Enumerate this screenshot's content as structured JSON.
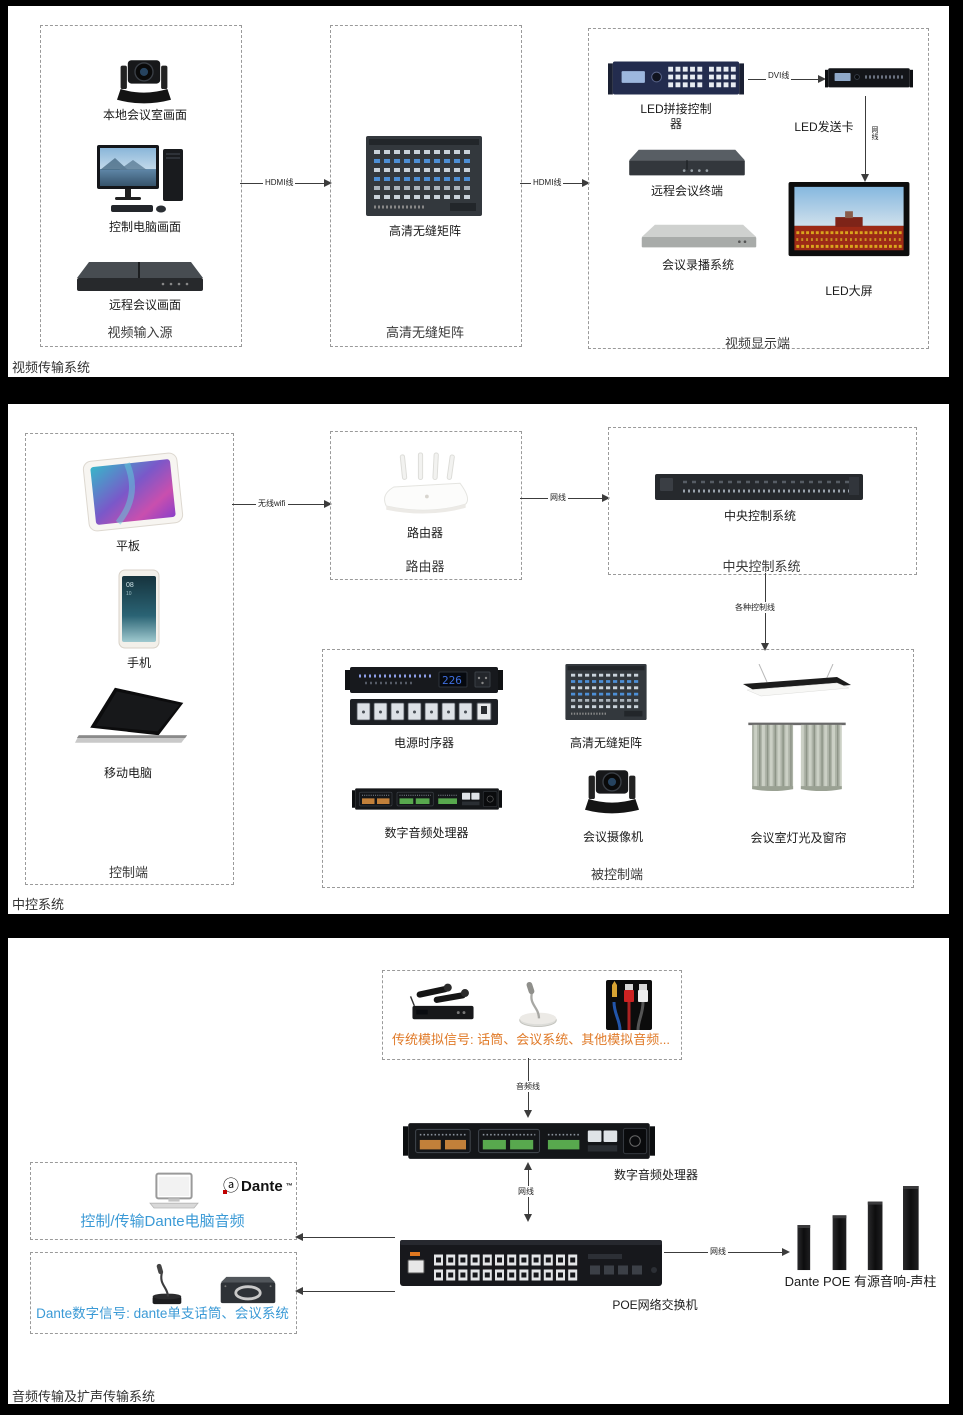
{
  "power_display": "226",
  "phone_screen": {
    "time": "08",
    "date": "10"
  },
  "colors": {
    "analog_label": "#e07a28",
    "dante_label": "#3b9ad6",
    "arrow": "#3c3c3c",
    "dante_logo_red": "#c00000"
  },
  "sections": {
    "video": {
      "label": "视频传输系统",
      "input_box": {
        "label": "视频输入源",
        "camera": "本地会议室画面",
        "pc": "控制电脑画面",
        "remote": "远程会议画面"
      },
      "matrix_box": {
        "label": "高清无缝矩阵",
        "device": "高清无缝矩阵"
      },
      "display_box": {
        "label": "视频显示端",
        "led_ctrl": "LED拼接控制器",
        "send_card": "LED发送卡",
        "terminal": "远程会议终端",
        "recorder": "会议录播系统",
        "screen": "LED大屏"
      },
      "arrows": {
        "in_to_matrix": "HDMI线",
        "matrix_to_display": "HDMI线",
        "ctrl_to_card": "DVI线",
        "card_to_screen": "网线"
      }
    },
    "control": {
      "label": "中控系统",
      "client_box": {
        "label": "控制端",
        "tablet": "平板",
        "phone": "手机",
        "laptop": "移动电脑"
      },
      "router_box": {
        "label": "路由器",
        "device": "路由器"
      },
      "central_box": {
        "label": "中央控制系统",
        "device": "中央控制系统"
      },
      "controlled_box": {
        "label": "被控制端",
        "power": "电源时序器",
        "matrix": "高清无缝矩阵",
        "dsp": "数字音频处理器",
        "camera": "会议摄像机",
        "light": "会议室灯光及窗帘"
      },
      "arrows": {
        "client_to_router": "无线wifi",
        "router_to_central": "网线",
        "central_to_controlled": "各种控制线"
      }
    },
    "audio": {
      "label": "音频传输及扩声传输系统",
      "analog_box": {
        "label": "传统模拟信号: 话筒、会议系统、其他模拟音频..."
      },
      "dsp_label": "数字音频处理器",
      "switch_label": "POE网络交换机",
      "speakers_label": "Dante POE 有源音响-声柱",
      "dante_pc_box": {
        "label": "控制/传输Dante电脑音频",
        "logo": "Dante",
        "logo_tm": "™"
      },
      "dante_dev_box": {
        "label": "Dante数字信号: dante单支话筒、会议系统"
      },
      "arrows": {
        "analog_to_dsp": "音频线",
        "dsp_to_switch": "网线",
        "switch_to_speakers": "网线"
      }
    }
  }
}
